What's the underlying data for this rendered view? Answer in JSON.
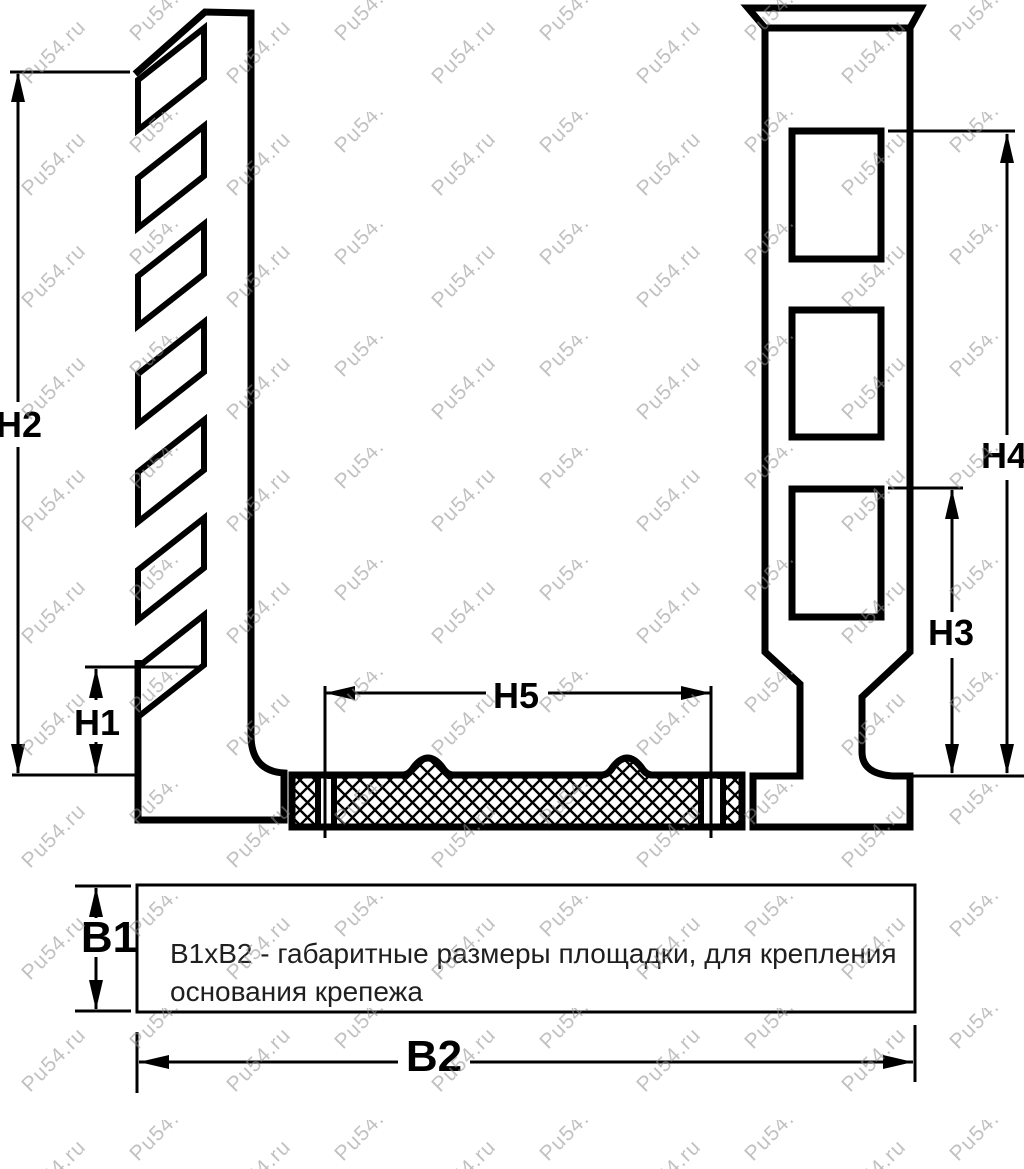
{
  "watermark": {
    "text": "Pu54.ru"
  },
  "dimensions": {
    "h1": "H1",
    "h2": "H2",
    "h3": "H3",
    "h4": "H4",
    "h5": "H5",
    "b1": "B1",
    "b2": "B2"
  },
  "note": {
    "line1": "B1xB2 - габаритные размеры площадки, для крепления",
    "line2": "основания крепежа"
  },
  "colors": {
    "line": "#000000",
    "note_text": "#1f1f1f",
    "watermark": "#8f8f8f"
  }
}
